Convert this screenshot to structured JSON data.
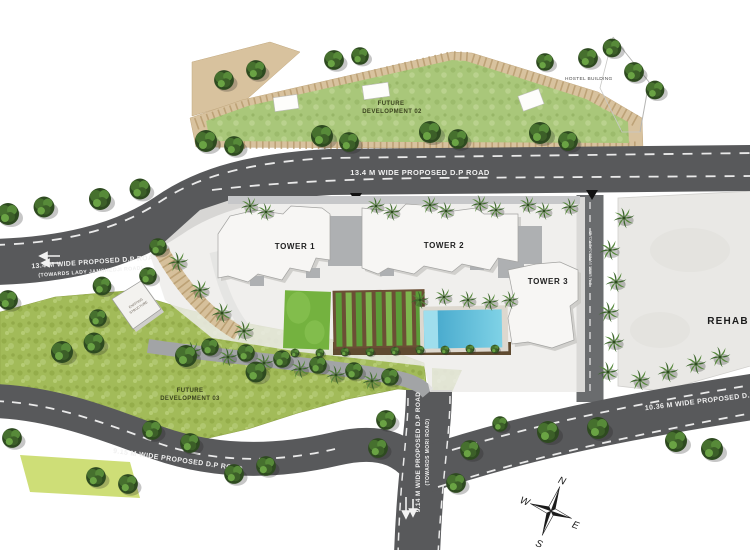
{
  "site_plan": {
    "towers": {
      "t1": "TOWER 1",
      "t2": "TOWER 2",
      "t3": "TOWER 3"
    },
    "areas": {
      "future_dev_02": {
        "line1": "FUTURE",
        "line2": "DEVELOPMENT 02"
      },
      "future_dev_03": {
        "line1": "FUTURE",
        "line2": "DEVELOPMENT 03"
      },
      "rehab": "REHAB",
      "hostel": "HOSTEL BUILDING",
      "existing_structure": {
        "line1": "EXISTING",
        "line2": "STRUCTURE"
      }
    },
    "roads": {
      "main": {
        "label": "13.4 M WIDE PROPOSED D.P ROAD"
      },
      "west": {
        "label": "13.4 M WIDE PROPOSED D.P ROAD",
        "direction": "(TOWARDS LADY JAMSHEDJI ROAD)"
      },
      "south_west": {
        "label": "9.15 M WIDE PROPOSED D.P ROAD"
      },
      "south": {
        "label": "9.14 M WIDE PROPOSED D.P ROAD",
        "direction": "(TOWARDS MORI ROAD)"
      },
      "south_east": {
        "label": "10.36 M WIDE PROPOSED D.P ROAD"
      },
      "internal": {
        "label": "6 M WIDE INTERNAL ROAD"
      }
    },
    "compass": {
      "n": "N",
      "e": "E",
      "s": "S",
      "w": "W"
    },
    "colors": {
      "road": "#58595b",
      "road_internal": "#6a6c6e",
      "grass": "#a2bb59",
      "grass_light": "#a9c77a",
      "flat_lawn": "#cede77",
      "tan_band": "#d8c29e",
      "pool_blue": "#45aed3",
      "building_white": "#f7f6f4",
      "rehab_fill": "#e9e8e5"
    }
  }
}
